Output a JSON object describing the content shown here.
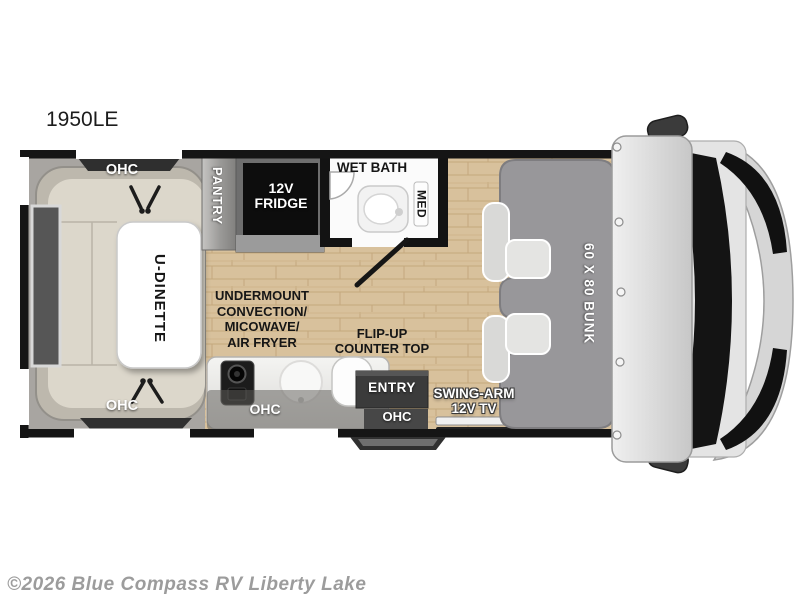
{
  "page": {
    "title": "1950LE",
    "watermark": "©2026 Blue Compass RV Liberty Lake"
  },
  "floorplan": {
    "labels": {
      "ohc_top": "OHC",
      "ohc_bottom": "OHC",
      "u_dinette": "U-DINETTE",
      "pantry": "PANTRY",
      "fridge": "12V\nFRIDGE",
      "wet_bath": "WET BATH",
      "med": "MED",
      "undermount": "UNDERMOUNT\nCONVECTION/\nMICOWAVE/\nAIR FRYER",
      "flip_up_counter": "FLIP-UP\nCOUNTER TOP",
      "ohc_kitchen": "OHC",
      "entry": "ENTRY",
      "ohc_entry": "OHC",
      "swing_arm_tv": "SWING-ARM\n12V TV",
      "bunk": "60 X 80 BUNK"
    },
    "colors": {
      "wall_black": "#151515",
      "wood_floor": "#d8c19c",
      "bunk_gray": "#98979a",
      "bench_beige": "#dcd7cb",
      "counter_gray": "#ececea",
      "cabinet_dark": "#3b3b3b",
      "cab_gray": "#d8d8d8",
      "label_light": "#ffffff",
      "label_dark": "#161616",
      "watermark_gray": "#9c9c9c"
    }
  }
}
